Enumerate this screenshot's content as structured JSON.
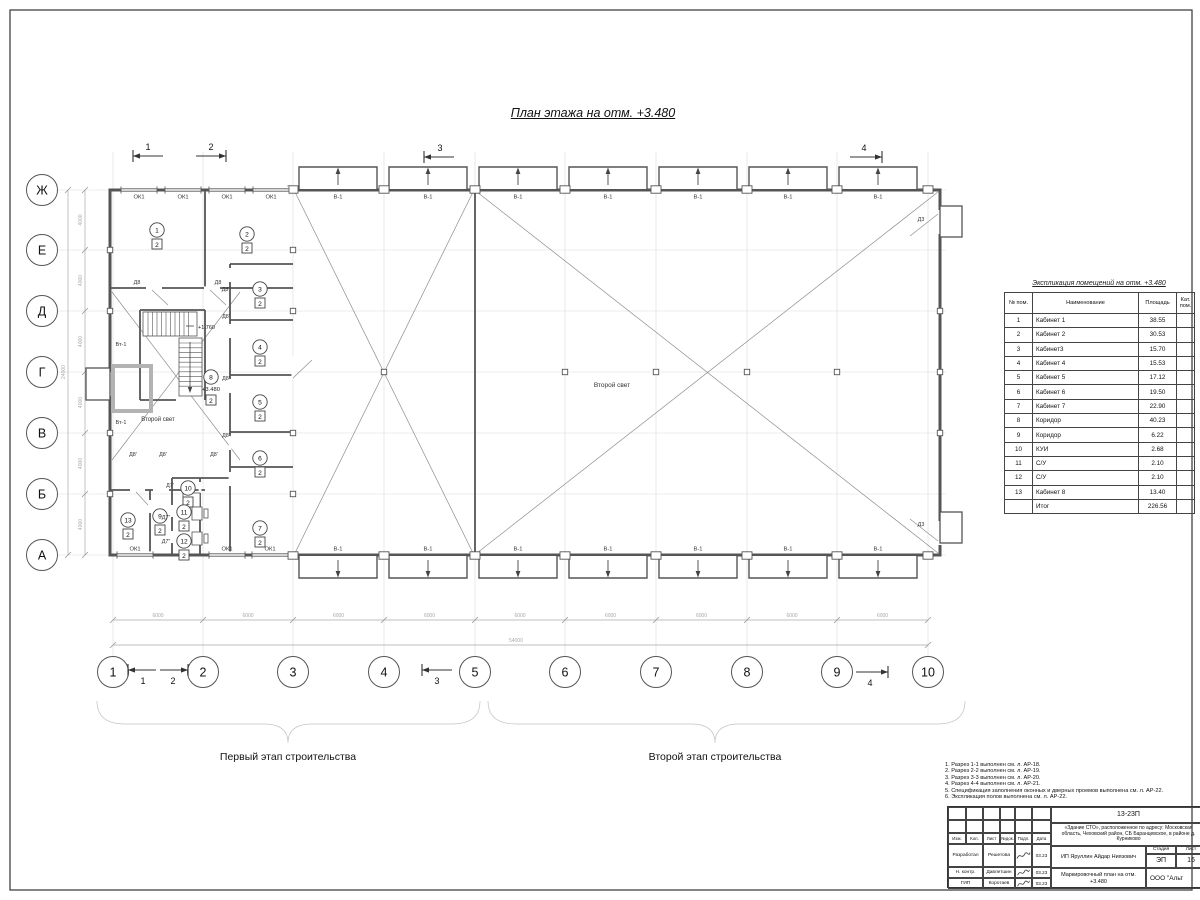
{
  "sheet": {
    "plan_title": "План этажа на отм. +3.480",
    "stage1_label": "Первый этап строительства",
    "stage2_label": "Второй этап строительства"
  },
  "axes": {
    "bottom": [
      "1",
      "2",
      "3",
      "4",
      "5",
      "6",
      "7",
      "8",
      "9",
      "10"
    ],
    "left": [
      "Ж",
      "Е",
      "Д",
      "Г",
      "В",
      "Б",
      "А"
    ],
    "dim_bottom_segment": "6000",
    "dim_bottom_total": "54000",
    "dim_left_segment": "4000",
    "dim_left_total": "24000"
  },
  "section_markers": [
    "1",
    "2",
    "3",
    "4"
  ],
  "plan": {
    "window_label": "ОК1",
    "gate_label": "В-1",
    "second_light": "Второй свет",
    "wall_gate_label": "Вт-1",
    "stair_level": "+1.760",
    "floor_level": "+3.480",
    "door_labels": [
      "Д8",
      "Д8",
      "Д8\"",
      "Д8'",
      "Д8'",
      "Д8'",
      "Д8'",
      "Д8'",
      "Д8'",
      "Д7'",
      "Д7\"",
      "Д7\"",
      "Д3",
      "Д3"
    ],
    "rooms": [
      {
        "num": "1",
        "cat": "2"
      },
      {
        "num": "2",
        "cat": "2"
      },
      {
        "num": "3",
        "cat": "2"
      },
      {
        "num": "4",
        "cat": "2"
      },
      {
        "num": "5",
        "cat": "2"
      },
      {
        "num": "6",
        "cat": "2"
      },
      {
        "num": "7",
        "cat": "2"
      },
      {
        "num": "8",
        "cat": "2"
      },
      {
        "num": "9",
        "cat": "2"
      },
      {
        "num": "10",
        "cat": "2"
      },
      {
        "num": "11",
        "cat": "2"
      },
      {
        "num": "12",
        "cat": "2"
      },
      {
        "num": "13",
        "cat": "2"
      }
    ]
  },
  "explication": {
    "title": "Экспликация помещений на отм. +3.480",
    "col_num": "№ пом.",
    "col_name": "Наименование",
    "col_area": "Площадь",
    "col_cat": "Кат. пом.",
    "rows": [
      [
        "1",
        "Кабинет 1",
        "38.55"
      ],
      [
        "2",
        "Кабинет 2",
        "30.53"
      ],
      [
        "3",
        "Кабинет3",
        "15.70"
      ],
      [
        "4",
        "Кабинет 4",
        "15.53"
      ],
      [
        "5",
        "Кабинет 5",
        "17.12"
      ],
      [
        "6",
        "Кабинет 6",
        "19.50"
      ],
      [
        "7",
        "Кабинет 7",
        "22.90"
      ],
      [
        "8",
        "Коридор",
        "40.23"
      ],
      [
        "9",
        "Коридор",
        "6.22"
      ],
      [
        "10",
        "КУИ",
        "2.68"
      ],
      [
        "11",
        "С/У",
        "2.10"
      ],
      [
        "12",
        "С/У",
        "2.10"
      ],
      [
        "13",
        "Кабинет 8",
        "13.40"
      ]
    ],
    "total_label": "Итог",
    "total_area": "226.56"
  },
  "notes": [
    "1. Разрез 1-1 выполнен см. л. АР-18.",
    "2. Разрез 2-2 выполнен см. л. АР-19.",
    "3. Разрез 3-3 выполнен см. л. АР-20.",
    "4. Разрез 4-4 выполнен см. л. АР-21.",
    "5. Спецификация заполнения оконных и дверных проемов выполнена см. л. АР-22.",
    "6. Экспликация полов выполнена см. л. АР-22."
  ],
  "titleblock": {
    "doc_number": "13-23П",
    "object_info": "«Здание СТО», расположенное по адресу: Московская область, Чеховский район, СБ Баранцевское, в районе д. Курниково",
    "cols": [
      "Изм.",
      "Кол.",
      "Лист",
      "№док.",
      "Подл.",
      "Дата"
    ],
    "sign_rows": [
      [
        "Разработал",
        "Решетова",
        "03.23"
      ],
      [
        "Н. контр.",
        "Давлетшин",
        "03.23"
      ],
      [
        "ГИП",
        "Коротаев",
        "03.23"
      ]
    ],
    "client": "ИП Яруллин Айдар Ниязович",
    "stage_label": "Стадия",
    "sheet_label": "Лист",
    "stage_value": "ЭП",
    "sheet_value": "16",
    "drawing_title": "Маркировочный план на отм. +3.480",
    "company": "ООО \"Альт"
  }
}
